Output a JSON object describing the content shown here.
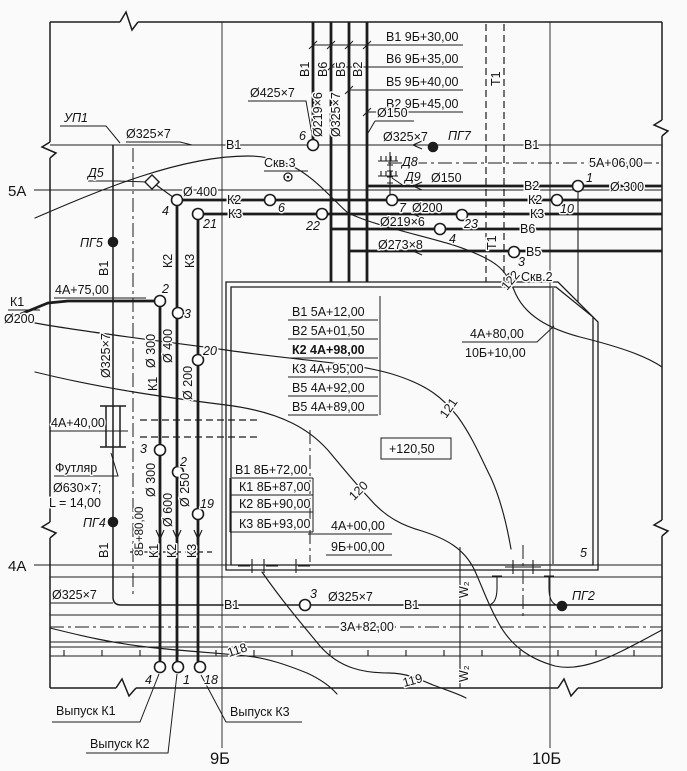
{
  "page": {
    "width": 687,
    "height": 771,
    "bg": "#fafafa",
    "ink": "#1c1c1c"
  },
  "labels": [
    {
      "name": "riser-table-row-1",
      "text": "В1 9Б+30,00",
      "x": 386,
      "y": 41
    },
    {
      "name": "riser-table-row-2",
      "text": "В6 9Б+35,00",
      "x": 386,
      "y": 63
    },
    {
      "name": "riser-table-row-3",
      "text": "В5 9Б+40,00",
      "x": 386,
      "y": 86
    },
    {
      "name": "riser-table-row-4",
      "text": "В2 9Б+45,00",
      "x": 386,
      "y": 108
    },
    {
      "name": "riser-label-v1",
      "text": "В1",
      "x": 309,
      "y": 77,
      "rot": -90
    },
    {
      "name": "riser-label-v6",
      "text": "В6",
      "x": 327,
      "y": 77,
      "rot": -90
    },
    {
      "name": "riser-label-v5",
      "text": "В5",
      "x": 345,
      "y": 77,
      "rot": -90
    },
    {
      "name": "riser-label-v2",
      "text": "В2",
      "x": 362,
      "y": 77,
      "rot": -90
    },
    {
      "name": "riser-dia-v6",
      "text": "Ø219×6",
      "x": 322,
      "y": 137,
      "rot": -90
    },
    {
      "name": "riser-dia-v5",
      "text": "Ø325×7",
      "x": 340,
      "y": 137,
      "rot": -90
    },
    {
      "name": "dia-425",
      "text": "Ø425×7",
      "x": 250,
      "y": 97
    },
    {
      "name": "dia-150-top",
      "text": "Ø150",
      "x": 377,
      "y": 117
    },
    {
      "name": "t1-label-top",
      "text": "Т1",
      "x": 500,
      "y": 86,
      "rot": -90
    },
    {
      "name": "up1-label",
      "text": "УП1",
      "x": 64,
      "y": 122,
      "cls": "it"
    },
    {
      "name": "dia-325-upleft",
      "text": "Ø325×7",
      "x": 126,
      "y": 138
    },
    {
      "name": "v1-label-left",
      "text": "В1",
      "x": 226,
      "y": 149
    },
    {
      "name": "mh6-top-num",
      "text": "6",
      "x": 299,
      "y": 140,
      "cls": "it"
    },
    {
      "name": "dia-325-pg7",
      "text": "Ø325×7",
      "x": 383,
      "y": 141
    },
    {
      "name": "pg7-label",
      "text": "ПГ7",
      "x": 448,
      "y": 140,
      "cls": "it"
    },
    {
      "name": "v1-label-right",
      "text": "В1",
      "x": 524,
      "y": 149
    },
    {
      "name": "coord-5a06",
      "text": "5А+06,00",
      "x": 589,
      "y": 167
    },
    {
      "name": "skv3-label",
      "text": "Скв.3",
      "x": 264,
      "y": 167
    },
    {
      "name": "d5-label",
      "text": "Д5",
      "x": 88,
      "y": 177,
      "cls": "it"
    },
    {
      "name": "d8-label",
      "text": "Д8",
      "x": 402,
      "y": 166,
      "cls": "it"
    },
    {
      "name": "d9-label",
      "text": "Д9",
      "x": 405,
      "y": 181,
      "cls": "it"
    },
    {
      "name": "dia-150-d9",
      "text": "Ø150",
      "x": 431,
      "y": 182
    },
    {
      "name": "axis-5a-label",
      "text": "5А",
      "x": 8,
      "y": 196,
      "cls": "lg"
    },
    {
      "name": "v2-label",
      "text": "В2",
      "x": 524,
      "y": 190
    },
    {
      "name": "mh1-num",
      "text": "1",
      "x": 586,
      "y": 182,
      "cls": "it"
    },
    {
      "name": "dia-300-right",
      "text": "Ø 300",
      "x": 610,
      "y": 191
    },
    {
      "name": "k2-label-left",
      "text": "К2",
      "x": 227,
      "y": 204
    },
    {
      "name": "k2-label-right",
      "text": "К2",
      "x": 528,
      "y": 204
    },
    {
      "name": "dia-400-k2h",
      "text": "Ø 400",
      "x": 183,
      "y": 196
    },
    {
      "name": "mh4-k2-num",
      "text": "4",
      "x": 162,
      "y": 215,
      "cls": "it"
    },
    {
      "name": "mh6-k2-num",
      "text": "6",
      "x": 278,
      "y": 212,
      "cls": "it"
    },
    {
      "name": "mh7-num",
      "text": "7",
      "x": 399,
      "y": 212,
      "cls": "it"
    },
    {
      "name": "dia-200-k2",
      "text": "Ø200",
      "x": 412,
      "y": 212
    },
    {
      "name": "mh10-num",
      "text": "10",
      "x": 560,
      "y": 213,
      "cls": "it"
    },
    {
      "name": "k3-label-left",
      "text": "К3",
      "x": 228,
      "y": 218
    },
    {
      "name": "k3-label-right",
      "text": "К3",
      "x": 530,
      "y": 218
    },
    {
      "name": "mh21-num",
      "text": "21",
      "x": 203,
      "y": 228,
      "cls": "it"
    },
    {
      "name": "mh22-num",
      "text": "22",
      "x": 306,
      "y": 230,
      "cls": "it"
    },
    {
      "name": "mh23-num",
      "text": "23",
      "x": 464,
      "y": 228,
      "cls": "it"
    },
    {
      "name": "dia-219-v6h",
      "text": "Ø219×6",
      "x": 380,
      "y": 226
    },
    {
      "name": "v6-label",
      "text": "В6",
      "x": 520,
      "y": 233
    },
    {
      "name": "mh4-v6-num",
      "text": "4",
      "x": 449,
      "y": 243,
      "cls": "it"
    },
    {
      "name": "dia-273-v5h",
      "text": "Ø273×8",
      "x": 378,
      "y": 249
    },
    {
      "name": "v5-label",
      "text": "В5",
      "x": 526,
      "y": 256
    },
    {
      "name": "mh3-v5-num",
      "text": "3",
      "x": 518,
      "y": 266,
      "cls": "it"
    },
    {
      "name": "t1-label-mid",
      "text": "Т1",
      "x": 496,
      "y": 250,
      "rot": -90
    },
    {
      "name": "skv2-label",
      "text": "Скв.2",
      "x": 521,
      "y": 281
    },
    {
      "name": "contour-122-label",
      "text": "122",
      "x": 507,
      "y": 291,
      "rot": -50
    },
    {
      "name": "pg5-label",
      "text": "ПГ5",
      "x": 80,
      "y": 247,
      "cls": "it"
    },
    {
      "name": "v1-rot-upper",
      "text": "В1",
      "x": 108,
      "y": 276,
      "rot": -90
    },
    {
      "name": "coord-8b80",
      "text": "8Б+80,00",
      "x": 143,
      "y": 556,
      "rot": -90,
      "cls": "sm"
    },
    {
      "name": "k1-in-label",
      "text": "К1",
      "x": 10,
      "y": 306
    },
    {
      "name": "k1-in-dia",
      "text": "Ø200",
      "x": 4,
      "y": 323
    },
    {
      "name": "coord-4a75",
      "text": "4А+75,00",
      "x": 55,
      "y": 294
    },
    {
      "name": "mh2-k1-num",
      "text": "2",
      "x": 162,
      "y": 293,
      "cls": "it"
    },
    {
      "name": "mh3-k2-num",
      "text": "3",
      "x": 184,
      "y": 318,
      "cls": "it"
    },
    {
      "name": "k2-rot-upper",
      "text": "К2",
      "x": 172,
      "y": 268,
      "rot": -90
    },
    {
      "name": "k3-rot-upper",
      "text": "К3",
      "x": 194,
      "y": 268,
      "rot": -90
    },
    {
      "name": "dia-300-k1v",
      "text": "Ø 300",
      "x": 155,
      "y": 368,
      "rot": -90
    },
    {
      "name": "dia-400-k2v",
      "text": "Ø 400",
      "x": 172,
      "y": 363,
      "rot": -90
    },
    {
      "name": "dia-200-k3v",
      "text": "Ø 200",
      "x": 192,
      "y": 400,
      "rot": -90
    },
    {
      "name": "k1-rot-upper",
      "text": "К1",
      "x": 157,
      "y": 391,
      "rot": -90
    },
    {
      "name": "mh20-num",
      "text": "20",
      "x": 203,
      "y": 355,
      "cls": "it"
    },
    {
      "name": "dia-325-v1v",
      "text": "Ø325×7",
      "x": 110,
      "y": 378,
      "rot": -90
    },
    {
      "name": "coord-4a40",
      "text": "4А+40,00",
      "x": 51,
      "y": 427
    },
    {
      "name": "futlyar-line-1",
      "text": "Футляр",
      "x": 55,
      "y": 472
    },
    {
      "name": "futlyar-line-2",
      "text": "Ø630×7;",
      "x": 53,
      "y": 492
    },
    {
      "name": "futlyar-line-3",
      "text": "L = 14,00",
      "x": 49,
      "y": 507
    },
    {
      "name": "pg4-label",
      "text": "ПГ4",
      "x": 83,
      "y": 527,
      "cls": "it"
    },
    {
      "name": "mh3-k1low-num",
      "text": "3",
      "x": 140,
      "y": 453,
      "cls": "it"
    },
    {
      "name": "mh2-k2low-num",
      "text": "2",
      "x": 180,
      "y": 466,
      "cls": "it"
    },
    {
      "name": "mh19-num",
      "text": "19",
      "x": 200,
      "y": 508,
      "cls": "it"
    },
    {
      "name": "dia-300-k1low",
      "text": "Ø 300",
      "x": 155,
      "y": 497,
      "rot": -90
    },
    {
      "name": "dia-600-k2low",
      "text": "Ø 600",
      "x": 172,
      "y": 527,
      "rot": -90
    },
    {
      "name": "dia-250-k3low",
      "text": "Ø 250",
      "x": 189,
      "y": 507,
      "rot": -90
    },
    {
      "name": "k1-rot-lower",
      "text": "К1",
      "x": 158,
      "y": 558,
      "rot": -90
    },
    {
      "name": "k2-rot-lower",
      "text": "К2",
      "x": 176,
      "y": 558,
      "rot": -90
    },
    {
      "name": "k3-rot-lower",
      "text": "К3",
      "x": 196,
      "y": 558,
      "rot": -90
    },
    {
      "name": "v1-rot-lower",
      "text": "В1",
      "x": 108,
      "y": 558,
      "rot": -90
    },
    {
      "name": "bldg-table-row-1",
      "text": "В1 5А+12,00",
      "x": 292,
      "y": 316
    },
    {
      "name": "bldg-table-row-2",
      "text": "В2 5А+01,50",
      "x": 292,
      "y": 335
    },
    {
      "name": "bldg-table-row-3",
      "text": "К2 4А+98,00",
      "x": 292,
      "y": 354,
      "cls": "b"
    },
    {
      "name": "bldg-table-row-4",
      "text": "К3 4А+95,00",
      "x": 292,
      "y": 373
    },
    {
      "name": "bldg-table-row-5",
      "text": "В5 4А+92,00",
      "x": 292,
      "y": 392
    },
    {
      "name": "bldg-table-row-6",
      "text": "В5 4А+89,00",
      "x": 292,
      "y": 411
    },
    {
      "name": "elevation-mark",
      "text": "+120,50",
      "x": 389,
      "y": 453
    },
    {
      "name": "low-table-row-1",
      "text": "В1 8Б+72,00",
      "x": 235,
      "y": 474
    },
    {
      "name": "low-table-row-2",
      "text": "К1 8Б+87,00",
      "x": 239,
      "y": 491
    },
    {
      "name": "low-table-row-3",
      "text": "К2 8Б+90,00",
      "x": 239,
      "y": 508
    },
    {
      "name": "low-table-row-4",
      "text": "К3 8Б+93,00",
      "x": 239,
      "y": 528
    },
    {
      "name": "coord-4a00",
      "text": "4А+00,00",
      "x": 331,
      "y": 530
    },
    {
      "name": "coord-9b00",
      "text": "9Б+00,00",
      "x": 331,
      "y": 551
    },
    {
      "name": "coord-4a80",
      "text": "4А+80,00",
      "x": 470,
      "y": 338
    },
    {
      "name": "coord-10b10",
      "text": "10Б+10,00",
      "x": 465,
      "y": 357
    },
    {
      "name": "contour-121-label",
      "text": "121",
      "x": 446,
      "y": 419,
      "rot": -55
    },
    {
      "name": "contour-120-label",
      "text": "120",
      "x": 354,
      "y": 501,
      "rot": -45
    },
    {
      "name": "bldg-corner-5",
      "text": "5",
      "x": 580,
      "y": 557,
      "cls": "it"
    },
    {
      "name": "axis-4a-label",
      "text": "4А",
      "x": 8,
      "y": 571,
      "cls": "lg"
    },
    {
      "name": "w2-label-1",
      "text": "W₂",
      "x": 468,
      "y": 598,
      "rot": -90
    },
    {
      "name": "w2-label-2",
      "text": "W₂",
      "x": 468,
      "y": 682,
      "rot": -90
    },
    {
      "name": "dia-325-bottomleft",
      "text": "Ø325×7",
      "x": 52,
      "y": 599
    },
    {
      "name": "v1-label-bottom-1",
      "text": "В1",
      "x": 224,
      "y": 609
    },
    {
      "name": "mh3-bottom-num",
      "text": "3",
      "x": 310,
      "y": 598,
      "cls": "it"
    },
    {
      "name": "dia-325-bottommid",
      "text": "Ø325×7",
      "x": 328,
      "y": 601
    },
    {
      "name": "v1-label-bottom-2",
      "text": "В1",
      "x": 404,
      "y": 609
    },
    {
      "name": "pg2-label",
      "text": "ПГ2",
      "x": 572,
      "y": 600,
      "cls": "it"
    },
    {
      "name": "coord-3a82",
      "text": "3А+82,00",
      "x": 340,
      "y": 631
    },
    {
      "name": "contour-118-label",
      "text": "118",
      "x": 229,
      "y": 657,
      "rot": -18
    },
    {
      "name": "contour-119-label",
      "text": "119",
      "x": 404,
      "y": 687,
      "rot": -15
    },
    {
      "name": "vypusk-k1-label",
      "text": "Выпуск К1",
      "x": 56,
      "y": 715
    },
    {
      "name": "vypusk-k2-label",
      "text": "Выпуск К2",
      "x": 90,
      "y": 748
    },
    {
      "name": "vypusk-k3-label",
      "text": "Выпуск К3",
      "x": 230,
      "y": 716
    },
    {
      "name": "mh4-out-num",
      "text": "4",
      "x": 145,
      "y": 684,
      "cls": "it"
    },
    {
      "name": "mh1-out-num",
      "text": "1",
      "x": 183,
      "y": 684,
      "cls": "it"
    },
    {
      "name": "mh18-out-num",
      "text": "18",
      "x": 204,
      "y": 684,
      "cls": "it"
    },
    {
      "name": "axis-9b-label",
      "text": "9Б",
      "x": 210,
      "y": 764,
      "cls": "xl"
    },
    {
      "name": "axis-10b-label",
      "text": "10Б",
      "x": 532,
      "y": 764,
      "cls": "xl"
    }
  ],
  "symbols": [
    {
      "name": "manhole-6-top",
      "kind": "manhole",
      "x": 313,
      "y": 145
    },
    {
      "name": "manhole-1",
      "kind": "manhole",
      "x": 578,
      "y": 186
    },
    {
      "name": "manhole-10",
      "kind": "manhole",
      "x": 557,
      "y": 200
    },
    {
      "name": "manhole-4-k2",
      "kind": "manhole",
      "x": 177,
      "y": 200
    },
    {
      "name": "manhole-6-k2",
      "kind": "manhole",
      "x": 270,
      "y": 200
    },
    {
      "name": "manhole-7",
      "kind": "manhole",
      "x": 392,
      "y": 200
    },
    {
      "name": "manhole-21",
      "kind": "manhole",
      "x": 198,
      "y": 214
    },
    {
      "name": "manhole-22",
      "kind": "manhole",
      "x": 322,
      "y": 214
    },
    {
      "name": "manhole-23",
      "kind": "manhole",
      "x": 462,
      "y": 215
    },
    {
      "name": "manhole-4-v6",
      "kind": "manhole",
      "x": 440,
      "y": 229
    },
    {
      "name": "manhole-3-v5",
      "kind": "manhole",
      "x": 514,
      "y": 252
    },
    {
      "name": "manhole-2-k1",
      "kind": "manhole",
      "x": 160,
      "y": 301
    },
    {
      "name": "manhole-3-k2",
      "kind": "manhole",
      "x": 178,
      "y": 313
    },
    {
      "name": "manhole-20",
      "kind": "manhole",
      "x": 198,
      "y": 360
    },
    {
      "name": "manhole-3-k1-low",
      "kind": "manhole",
      "x": 160,
      "y": 450
    },
    {
      "name": "manhole-2-k2-low",
      "kind": "manhole",
      "x": 178,
      "y": 472
    },
    {
      "name": "manhole-19",
      "kind": "manhole",
      "x": 198,
      "y": 514
    },
    {
      "name": "manhole-3-v1",
      "kind": "manhole",
      "x": 305,
      "y": 605
    },
    {
      "name": "manhole-4-outfall",
      "kind": "manhole",
      "x": 160,
      "y": 667
    },
    {
      "name": "manhole-1-outfall",
      "kind": "manhole",
      "x": 178,
      "y": 667
    },
    {
      "name": "manhole-18-outfall",
      "kind": "manhole",
      "x": 200,
      "y": 667
    },
    {
      "name": "hydrant-pg5",
      "kind": "hydrant",
      "x": 113,
      "y": 242
    },
    {
      "name": "hydrant-pg7",
      "kind": "hydrant",
      "x": 433,
      "y": 147
    },
    {
      "name": "hydrant-pg4",
      "kind": "hydrant",
      "x": 113,
      "y": 522
    },
    {
      "name": "hydrant-pg2",
      "kind": "hydrant",
      "x": 562,
      "y": 606
    },
    {
      "name": "borehole-skv3",
      "kind": "borehole",
      "x": 288,
      "y": 177
    },
    {
      "name": "borehole-skv2",
      "kind": "borehole",
      "x": 511,
      "y": 277
    },
    {
      "name": "node-d5",
      "kind": "diamond",
      "x": 152,
      "y": 182
    }
  ]
}
